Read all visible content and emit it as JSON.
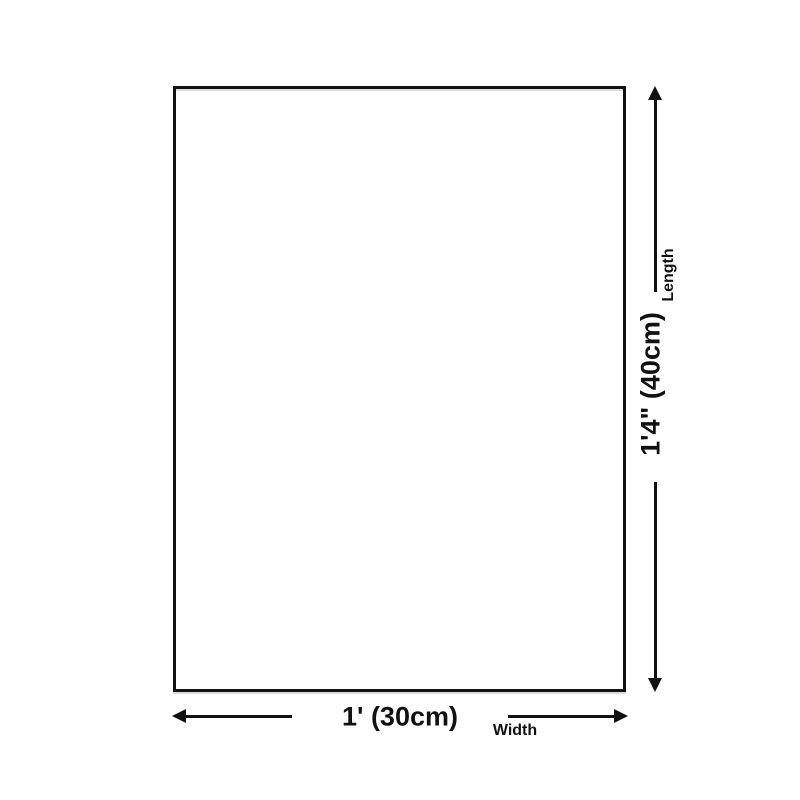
{
  "diagram": {
    "background_color": "#ffffff",
    "ink_color": "#111111",
    "length": {
      "value": "1'4\" (40cm)",
      "label": "Length"
    },
    "width": {
      "value": "1' (30cm)",
      "label": "Width"
    }
  }
}
